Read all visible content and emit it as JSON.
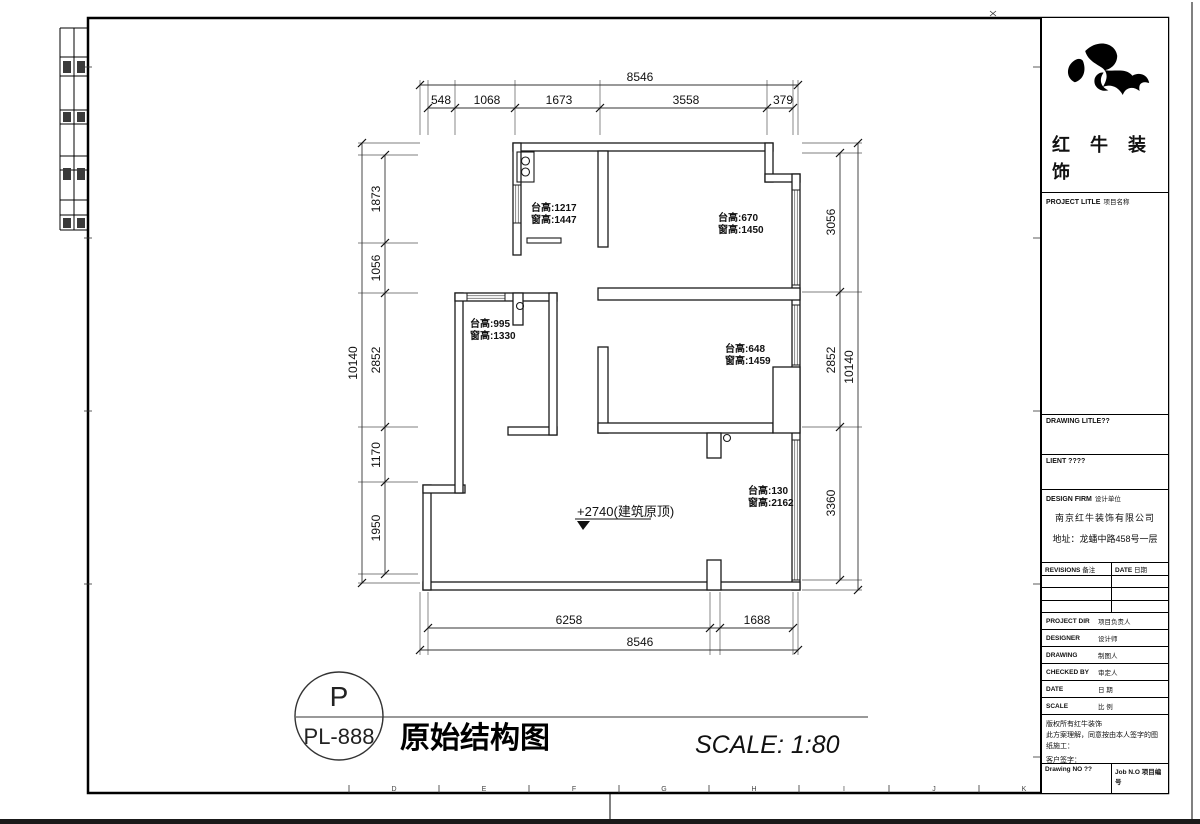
{
  "sheet": {
    "grid_letters": [
      "D",
      "E",
      "F",
      "G",
      "H",
      "I",
      "J",
      "K"
    ]
  },
  "plan": {
    "dims": {
      "top_total": "8546",
      "top": [
        "548",
        "1068",
        "1673",
        "3558",
        "379"
      ],
      "left_total": "10140",
      "left": [
        "1873",
        "1056",
        "2852",
        "1170",
        "1950"
      ],
      "right": [
        "3056",
        "2852",
        "3360"
      ],
      "right_total": "10140",
      "bottom": [
        "6258",
        "1688"
      ],
      "bottom_total": "8546"
    },
    "annotations": [
      {
        "line1": "台高:1217",
        "line2": "窗高:1447"
      },
      {
        "line1": "台高:670",
        "line2": "窗高:1450"
      },
      {
        "line1": "台高:995",
        "line2": "窗高:1330"
      },
      {
        "line1": "台高:648",
        "line2": "窗高:1459"
      },
      {
        "line1": "台高:130",
        "line2": "窗高:2162"
      }
    ],
    "level_mark": "+2740(建筑原顶)"
  },
  "titlebar": {
    "code_letter": "P",
    "code": "PL-888",
    "title": "原始结构图",
    "scale": "SCALE: 1:80"
  },
  "titleblock": {
    "brand": "红牛装饰",
    "project": {
      "en": "PROJECT LITLE",
      "cn": "项目名称"
    },
    "drawing_title": {
      "en": "DRAWING LITLE??"
    },
    "client": {
      "en": "LIENT ????"
    },
    "firm": {
      "en": "DESIGN FIRM",
      "cn": "设计单位",
      "name": "南京红牛装饰有限公司",
      "address": "地址：龙蟠中路458号一层"
    },
    "revisions": {
      "left_en": "REVISIONS",
      "left_cn": "备注",
      "right_en": "DATE",
      "right_cn": "日期"
    },
    "rows": [
      {
        "en": "PROJECT DIR",
        "cn": "项目负责人"
      },
      {
        "en": "DESIGNER",
        "cn": "设计师"
      },
      {
        "en": "DRAWING",
        "cn": "制图人"
      },
      {
        "en": "CHECKED BY",
        "cn": "审定人"
      },
      {
        "en": "DATE",
        "cn": "日 期"
      },
      {
        "en": "SCALE",
        "cn": "比 例"
      }
    ],
    "notes": [
      "版权所有红牛装饰",
      "此方案理解，同意按由本人签字的图纸施工：",
      "客户签字："
    ],
    "footer": {
      "left": "Drawing NO ??",
      "right": "Job N.O 项目编号"
    }
  }
}
